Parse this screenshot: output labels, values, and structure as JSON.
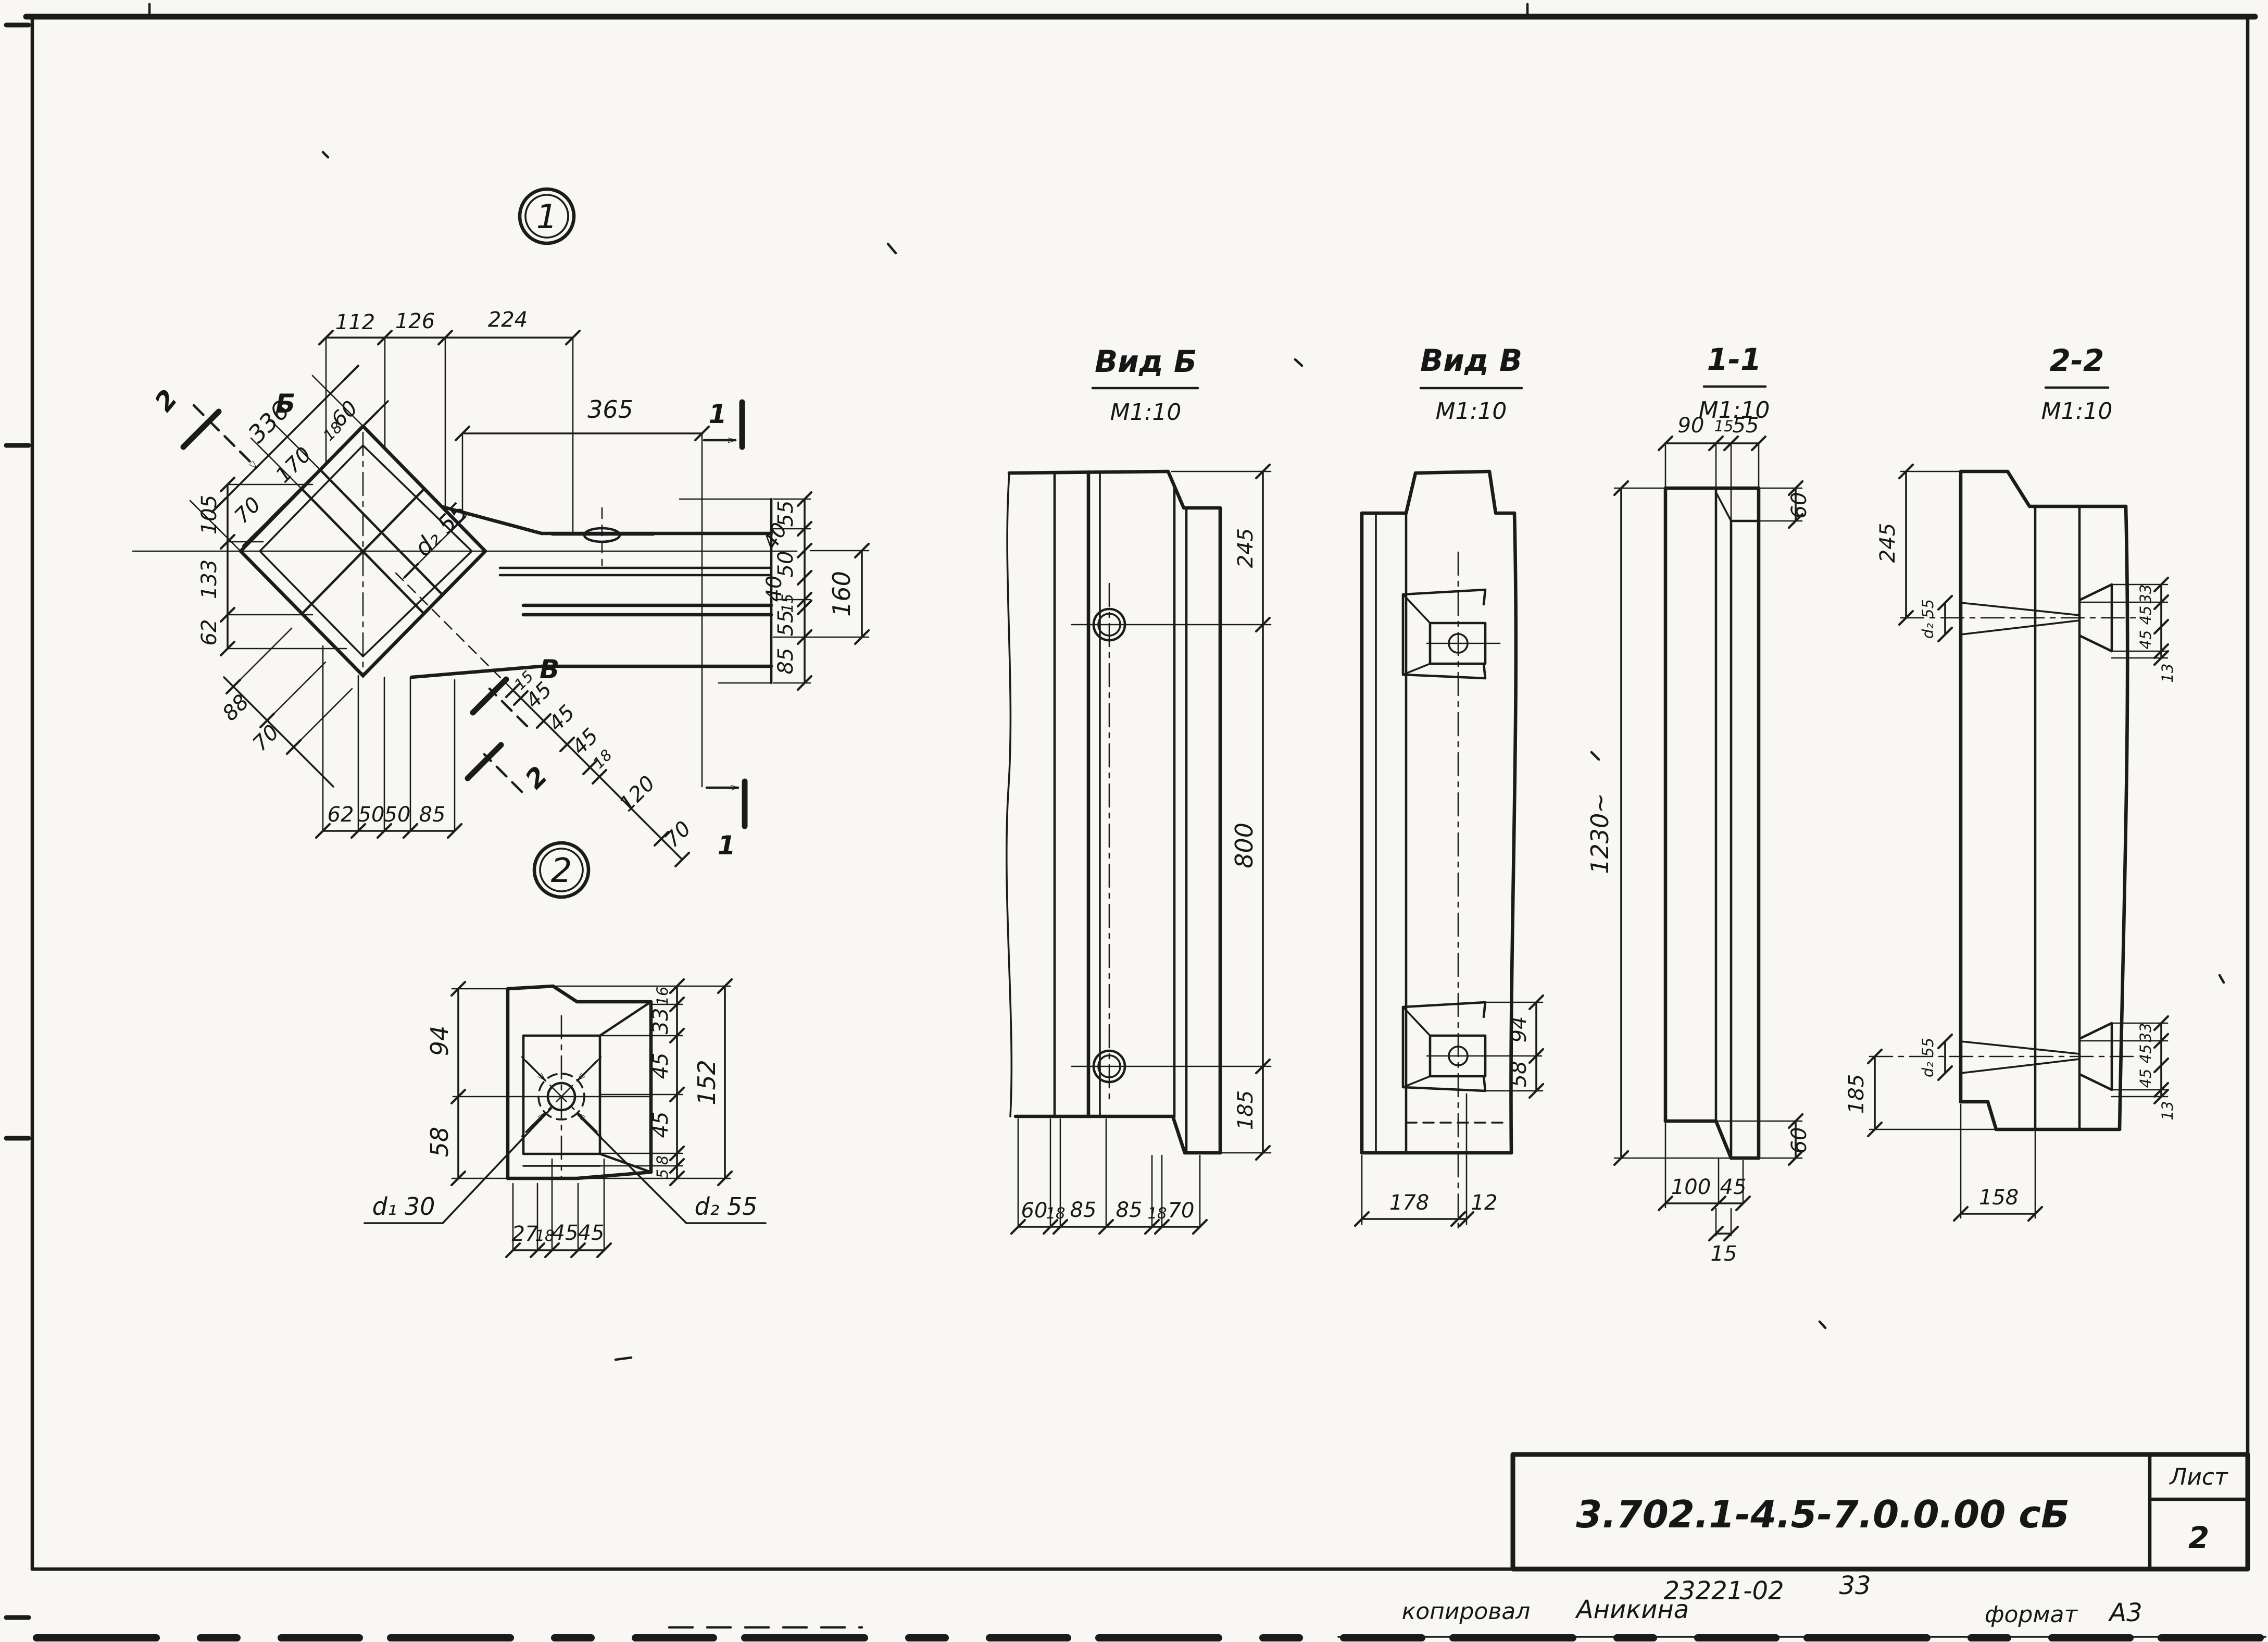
{
  "title_block": {
    "doc_number": "3.702.1-4.5-7.0.0.00 сБ",
    "sheet_label": "Лист",
    "sheet_number": "2",
    "stamp_code": "23221-02",
    "stamp_page": "33",
    "copied_label": "копировал",
    "copied_name": "Аникина",
    "format_label": "формат",
    "format_value": "А3"
  },
  "plan": {
    "detail_marker_1": "1",
    "detail_marker_2": "2",
    "top_chain": [
      "112",
      "126",
      "224"
    ],
    "offset_dim": "365",
    "diag_total": "336",
    "diag_chain": [
      "70",
      "170",
      "18",
      "60"
    ],
    "left_chain": [
      "105",
      "133",
      "62"
    ],
    "lower_diag_chain": [
      "88",
      "70"
    ],
    "mid_diag_chain": [
      "15",
      "45",
      "45",
      "45",
      "18",
      "120",
      "70"
    ],
    "bottom_chain": [
      "62",
      "50",
      "50",
      "85"
    ],
    "right_chain": [
      "55",
      "40",
      "50",
      "40",
      "15",
      "55",
      "85"
    ],
    "right_total": "160",
    "hole_dim": "d₂ 55",
    "section_mark_1": "1",
    "section_mark_2": "2",
    "view_mark_b": "Б",
    "view_mark_v": "В"
  },
  "detail": {
    "left_dims": [
      "94",
      "58"
    ],
    "right_chain": [
      "16",
      "33",
      "45",
      "45",
      "8",
      "5"
    ],
    "right_total": "152",
    "bottom_chain": [
      "27",
      "18",
      "45",
      "45"
    ],
    "d1_label": "d₁ 30",
    "d2_label": "d₂ 55"
  },
  "view_b": {
    "title": "Вид Б",
    "scale": "М1:10",
    "right_dims": [
      "245",
      "800",
      "185"
    ],
    "bottom_chain": [
      "60",
      "18",
      "85",
      "85",
      "18",
      "70"
    ]
  },
  "view_v": {
    "title": "Вид В",
    "scale": "М1:10",
    "pocket_dims": [
      "94",
      "58"
    ],
    "bottom_chain": [
      "178",
      "12"
    ]
  },
  "section_11": {
    "title": "1-1",
    "scale": "М1:10",
    "top_chain": [
      "90",
      "15",
      "55"
    ],
    "top_step": "60",
    "height": "1230~",
    "bottom_chain": [
      "100",
      "45"
    ],
    "bottom_inset": "15",
    "bottom_step": "60"
  },
  "section_22": {
    "title": "2-2",
    "scale": "М1:10",
    "left_top": "245",
    "left_bottom": "185",
    "cone_dim_top": "d₂ 55",
    "cone_dim_bottom": "d₂ 55",
    "tenon_top_chain": [
      "33",
      "45",
      "45"
    ],
    "tenon_top_offset": "13",
    "tenon_bottom_chain": [
      "33",
      "45",
      "45"
    ],
    "tenon_bottom_offset": "13",
    "bottom_dim": "158"
  }
}
